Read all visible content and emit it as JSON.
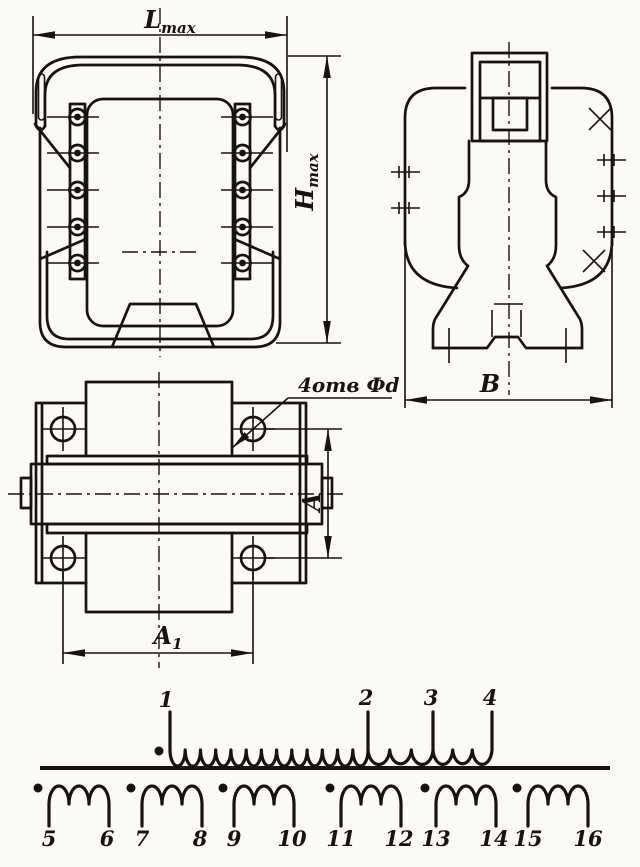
{
  "ink": "#17130e",
  "paper": "#fbfaf6",
  "front_view": {
    "dim_width": {
      "base": "L",
      "sub": "max"
    },
    "dim_height": {
      "base": "H",
      "sub": "max"
    },
    "terminal_pins_per_side": 5
  },
  "side_view": {
    "dim_width": "В",
    "pin_marks_left": 2,
    "pin_marks_right": 3,
    "x_marks": 2
  },
  "top_view": {
    "holes_label": "4отв Фd",
    "dim_a": "A",
    "dim_a1": {
      "base": "A",
      "sub": "1"
    },
    "mounting_holes": 4
  },
  "schematic": {
    "primary": {
      "terminals": [
        "1",
        "2",
        "3",
        "4"
      ],
      "arcs_between_taps": [
        13,
        3,
        3
      ],
      "has_polarity_dot": true
    },
    "arcs_per_secondary": 3,
    "secondaries": [
      {
        "left": "5",
        "right": "6"
      },
      {
        "left": "7",
        "right": "8"
      },
      {
        "left": "9",
        "right": "10"
      },
      {
        "left": "11",
        "right": "12"
      },
      {
        "left": "13",
        "right": "14"
      },
      {
        "left": "15",
        "right": "16"
      }
    ]
  }
}
